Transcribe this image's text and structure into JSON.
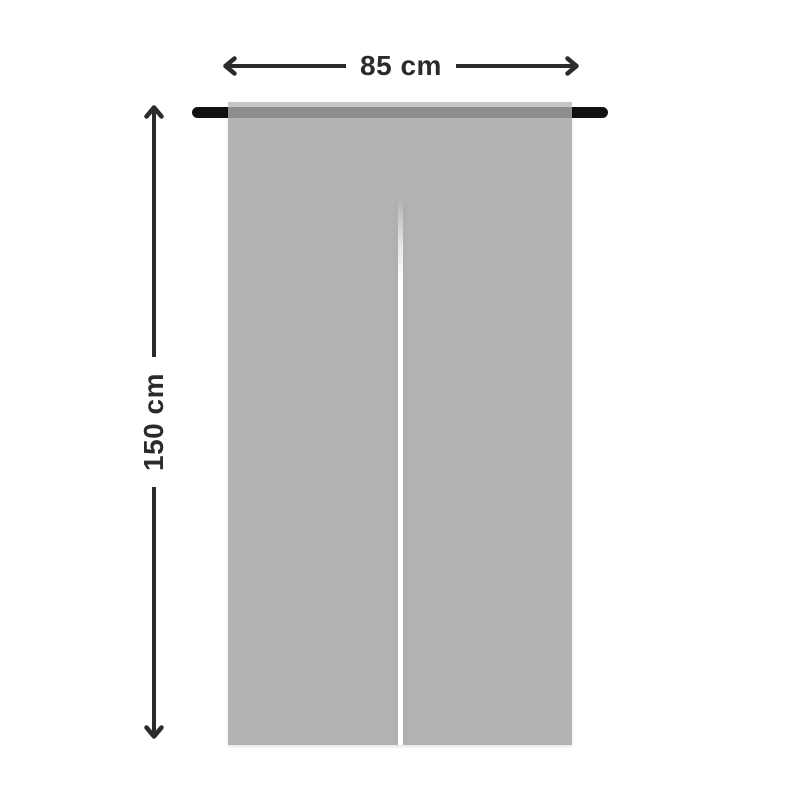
{
  "diagram": {
    "subject": "noren-split-curtain-with-rod",
    "dimensions": {
      "width": {
        "label": "85 cm"
      },
      "height": {
        "label": "150 cm"
      }
    },
    "icons": {
      "west": "arrow-left-icon",
      "east": "arrow-right-icon",
      "north": "arrow-up-icon",
      "south": "arrow-down-icon"
    },
    "colors": {
      "background": "#ffffff",
      "dimension_ink": "#2b2b2b",
      "rod": "#121212",
      "fabric": "#b4b4b4",
      "fabric_top_hem": "#c6c6c6",
      "rod_band": "#8e8e8e",
      "split": "#ffffff"
    }
  }
}
